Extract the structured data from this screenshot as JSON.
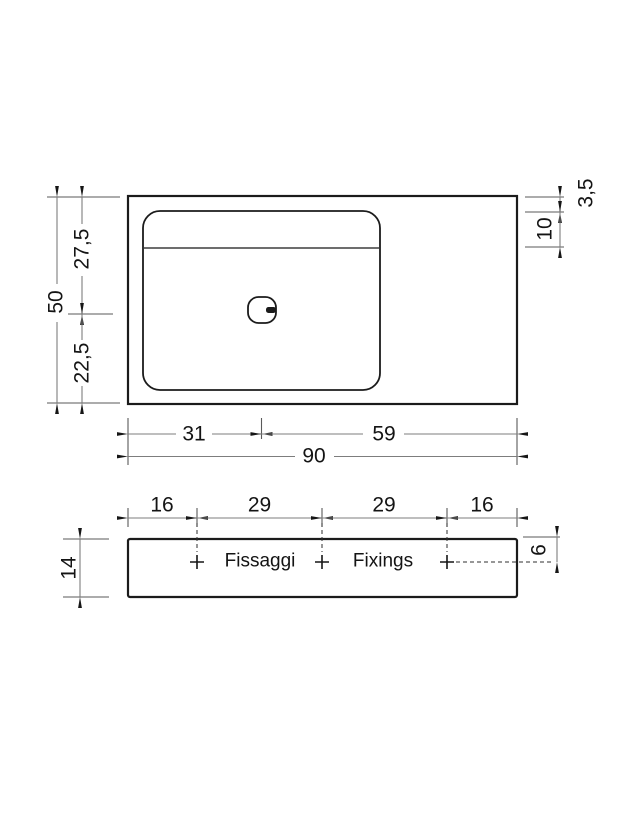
{
  "plan": {
    "dims": {
      "overall_width": "90",
      "drain_from_left": "31",
      "drain_from_right": "59",
      "overall_depth": "50",
      "basin_upper_depth": "27,5",
      "basin_lower_depth": "22,5",
      "rim_thickness": "3,5",
      "deck_width": "10"
    }
  },
  "front": {
    "dims": {
      "height": "14",
      "left_offset": "16",
      "left_spacing": "29",
      "right_spacing": "29",
      "right_offset": "16",
      "fixing_inset": "6"
    },
    "labels": {
      "fixings_it": "Fissaggi",
      "fixings_en": "Fixings"
    }
  },
  "colors": {
    "outline": "#1b1b1b",
    "dimension_line": "#7d7d7d",
    "text": "#141414",
    "background": "#ffffff"
  }
}
